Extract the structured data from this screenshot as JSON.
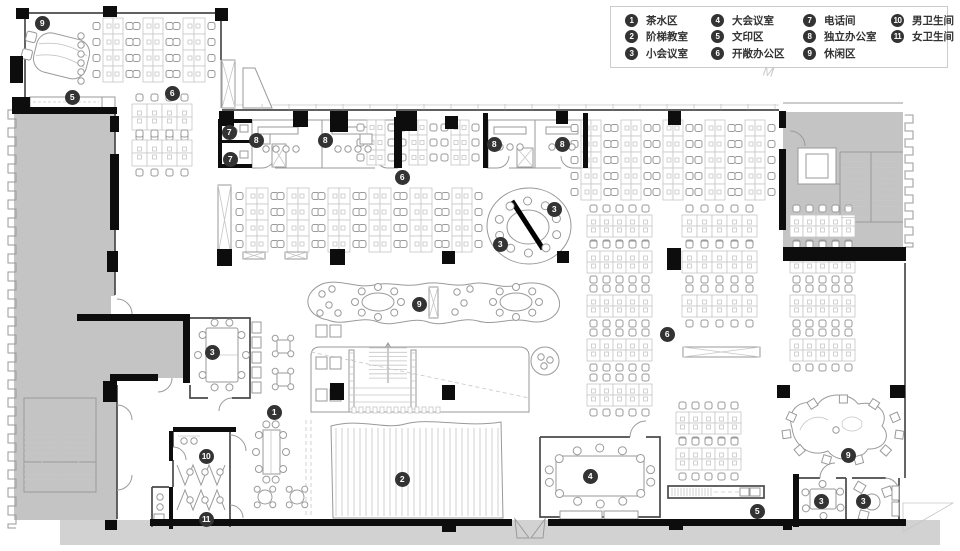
{
  "title": "办公楼层平面图",
  "watermark": "M",
  "colors": {
    "background": "#ffffff",
    "wall_black": "#0d0d0d",
    "wall_dark": "#4a4a4a",
    "line_light": "#c6c6c6",
    "line_mid": "#9a9a9a",
    "gray_zone": "#c4c4c4",
    "gray_walk": "#d2d2d2",
    "marker_bg": "#333333",
    "marker_text": "#ffffff",
    "legend_border": "#cccccc",
    "legend_text": "#333333"
  },
  "legend": {
    "items": [
      {
        "num": "1",
        "label": "茶水区"
      },
      {
        "num": "2",
        "label": "阶梯教室"
      },
      {
        "num": "3",
        "label": "小会议室"
      },
      {
        "num": "4",
        "label": "大会议室"
      },
      {
        "num": "5",
        "label": "文印区"
      },
      {
        "num": "6",
        "label": "开敞办公区"
      },
      {
        "num": "7",
        "label": "电话间"
      },
      {
        "num": "8",
        "label": "独立办公室"
      },
      {
        "num": "9",
        "label": "休闲区"
      },
      {
        "num": "10",
        "label": "男卫生间"
      },
      {
        "num": "11",
        "label": "女卫生间"
      }
    ]
  },
  "markers": [
    {
      "n": "9",
      "x": 42,
      "y": 23
    },
    {
      "n": "5",
      "x": 72,
      "y": 97
    },
    {
      "n": "6",
      "x": 172,
      "y": 93
    },
    {
      "n": "7",
      "x": 229,
      "y": 132
    },
    {
      "n": "8",
      "x": 256,
      "y": 140
    },
    {
      "n": "8",
      "x": 325,
      "y": 140
    },
    {
      "n": "7",
      "x": 230,
      "y": 159
    },
    {
      "n": "6",
      "x": 402,
      "y": 177
    },
    {
      "n": "8",
      "x": 494,
      "y": 144
    },
    {
      "n": "8",
      "x": 562,
      "y": 144
    },
    {
      "n": "3",
      "x": 554,
      "y": 209
    },
    {
      "n": "3",
      "x": 500,
      "y": 244
    },
    {
      "n": "9",
      "x": 419,
      "y": 304
    },
    {
      "n": "6",
      "x": 667,
      "y": 334
    },
    {
      "n": "3",
      "x": 212,
      "y": 352
    },
    {
      "n": "1",
      "x": 274,
      "y": 412
    },
    {
      "n": "10",
      "x": 206,
      "y": 456
    },
    {
      "n": "2",
      "x": 402,
      "y": 479
    },
    {
      "n": "4",
      "x": 590,
      "y": 476
    },
    {
      "n": "11",
      "x": 206,
      "y": 519
    },
    {
      "n": "5",
      "x": 757,
      "y": 511
    },
    {
      "n": "9",
      "x": 848,
      "y": 455
    },
    {
      "n": "3",
      "x": 821,
      "y": 501
    },
    {
      "n": "3",
      "x": 863,
      "y": 501
    }
  ],
  "floorplan": {
    "desk_clusters": [
      [
        103,
        18,
        2,
        4,
        10,
        16,
        "v"
      ],
      [
        143,
        18,
        2,
        4,
        10,
        16,
        "v"
      ],
      [
        183,
        18,
        2,
        4,
        11,
        16,
        "v"
      ],
      [
        132,
        104,
        4,
        2,
        15,
        13,
        "h"
      ],
      [
        132,
        140,
        4,
        2,
        15,
        13,
        "h"
      ],
      [
        367,
        120,
        2,
        3,
        9,
        15,
        "v"
      ],
      [
        409,
        120,
        2,
        3,
        9,
        15,
        "v"
      ],
      [
        451,
        120,
        2,
        3,
        9,
        15,
        "v"
      ],
      [
        246,
        188,
        2,
        4,
        11,
        16,
        "v"
      ],
      [
        287,
        188,
        2,
        4,
        11,
        16,
        "v"
      ],
      [
        328,
        188,
        2,
        4,
        11,
        16,
        "v"
      ],
      [
        369,
        188,
        2,
        4,
        11,
        16,
        "v"
      ],
      [
        410,
        188,
        2,
        4,
        11,
        16,
        "v"
      ],
      [
        452,
        188,
        2,
        4,
        10,
        16,
        "v"
      ],
      [
        581,
        120,
        2,
        5,
        10,
        16,
        "v"
      ],
      [
        621,
        120,
        2,
        5,
        10,
        16,
        "v"
      ],
      [
        663,
        120,
        2,
        5,
        10,
        16,
        "v"
      ],
      [
        705,
        120,
        2,
        5,
        10,
        16,
        "v"
      ],
      [
        745,
        120,
        2,
        5,
        10,
        16,
        "v"
      ],
      [
        587,
        215,
        5,
        2,
        13,
        11,
        "h"
      ],
      [
        587,
        251,
        5,
        2,
        13,
        11,
        "h"
      ],
      [
        587,
        295,
        5,
        2,
        13,
        11,
        "h"
      ],
      [
        587,
        339,
        5,
        2,
        13,
        11,
        "h"
      ],
      [
        587,
        384,
        5,
        2,
        13,
        11,
        "h"
      ],
      [
        682,
        215,
        5,
        2,
        15,
        11,
        "h"
      ],
      [
        682,
        251,
        5,
        2,
        15,
        11,
        "h"
      ],
      [
        682,
        295,
        5,
        2,
        15,
        11,
        "h"
      ],
      [
        790,
        215,
        5,
        2,
        13,
        11,
        "h"
      ],
      [
        790,
        251,
        5,
        2,
        13,
        11,
        "h"
      ],
      [
        790,
        295,
        5,
        2,
        13,
        11,
        "h"
      ],
      [
        790,
        339,
        5,
        2,
        13,
        11,
        "h"
      ],
      [
        676,
        412,
        5,
        2,
        13,
        11,
        "h"
      ],
      [
        676,
        448,
        5,
        2,
        13,
        11,
        "h"
      ]
    ],
    "black_rects": [
      [
        16,
        8,
        13,
        11
      ],
      [
        103,
        6,
        14,
        11
      ],
      [
        215,
        8,
        13,
        13
      ],
      [
        10,
        56,
        13,
        27
      ],
      [
        12,
        97,
        18,
        17
      ],
      [
        14,
        107,
        103,
        7
      ],
      [
        219,
        111,
        15,
        15
      ],
      [
        293,
        111,
        15,
        16
      ],
      [
        330,
        111,
        18,
        21
      ],
      [
        396,
        111,
        21,
        20
      ],
      [
        445,
        116,
        13,
        13
      ],
      [
        556,
        111,
        12,
        13
      ],
      [
        668,
        111,
        13,
        14
      ],
      [
        110,
        116,
        9,
        16
      ],
      [
        110,
        154,
        9,
        76
      ],
      [
        107,
        251,
        11,
        21
      ],
      [
        217,
        249,
        15,
        17
      ],
      [
        330,
        249,
        15,
        16
      ],
      [
        442,
        251,
        13,
        13
      ],
      [
        557,
        251,
        12,
        12
      ],
      [
        667,
        248,
        14,
        22
      ],
      [
        330,
        383,
        14,
        17
      ],
      [
        442,
        385,
        13,
        15
      ],
      [
        103,
        381,
        14,
        21
      ],
      [
        105,
        520,
        12,
        10
      ],
      [
        777,
        385,
        13,
        13
      ],
      [
        890,
        385,
        15,
        13
      ],
      [
        669,
        520,
        14,
        10
      ],
      [
        783,
        520,
        9,
        10
      ],
      [
        442,
        523,
        14,
        9
      ],
      [
        779,
        111,
        7,
        17
      ],
      [
        779,
        149,
        7,
        81
      ],
      [
        783,
        247,
        123,
        14
      ],
      [
        218,
        119,
        34,
        4
      ],
      [
        218,
        119,
        4,
        49
      ],
      [
        218,
        140,
        34,
        3
      ],
      [
        218,
        164,
        34,
        4
      ],
      [
        394,
        117,
        8,
        51
      ],
      [
        483,
        113,
        5,
        55
      ],
      [
        583,
        113,
        5,
        55
      ],
      [
        77,
        314,
        112,
        7
      ],
      [
        183,
        314,
        7,
        69
      ],
      [
        110,
        374,
        48,
        7
      ],
      [
        173,
        427,
        60,
        5
      ],
      [
        169,
        431,
        4,
        30
      ],
      [
        169,
        487,
        4,
        42
      ],
      [
        227,
        427,
        9,
        5
      ],
      [
        150,
        519,
        362,
        7
      ],
      [
        548,
        519,
        358,
        7
      ],
      [
        793,
        474,
        6,
        53
      ]
    ],
    "cabinets": [
      [
        222,
        60,
        13,
        48
      ],
      [
        218,
        185,
        13,
        70
      ],
      [
        243,
        252,
        22,
        7
      ],
      [
        285,
        252,
        22,
        7
      ],
      [
        683,
        347,
        77,
        10
      ],
      [
        429,
        287,
        9,
        31
      ],
      [
        517,
        148,
        16,
        19
      ],
      [
        272,
        144,
        14,
        23
      ]
    ],
    "benches": [
      [
        252,
        322,
        9,
        11
      ],
      [
        252,
        337,
        9,
        11
      ],
      [
        252,
        352,
        9,
        11
      ],
      [
        252,
        367,
        9,
        11
      ],
      [
        252,
        382,
        9,
        11
      ],
      [
        316,
        325,
        11,
        12
      ],
      [
        330,
        325,
        11,
        12
      ],
      [
        316,
        357,
        11,
        12
      ],
      [
        330,
        357,
        11,
        12
      ],
      [
        316,
        389,
        11,
        12
      ],
      [
        330,
        389,
        11,
        12
      ],
      [
        240,
        125,
        8,
        7
      ],
      [
        240,
        151,
        8,
        7
      ],
      [
        258,
        134,
        12,
        10
      ],
      [
        360,
        134,
        12,
        10
      ],
      [
        740,
        488,
        9,
        8
      ],
      [
        750,
        488,
        10,
        8
      ],
      [
        892,
        486,
        7,
        14
      ],
      [
        892,
        502,
        7,
        14
      ],
      [
        154,
        514,
        10,
        8
      ],
      [
        806,
        154,
        22,
        24
      ],
      [
        560,
        511,
        42,
        8
      ],
      [
        604,
        511,
        34,
        8
      ]
    ],
    "dots": [
      [
        234,
        131
      ],
      [
        234,
        158
      ],
      [
        266,
        149
      ],
      [
        276,
        149
      ],
      [
        286,
        149
      ],
      [
        296,
        149
      ],
      [
        338,
        149
      ],
      [
        348,
        149
      ],
      [
        358,
        149
      ],
      [
        368,
        149
      ],
      [
        500,
        147
      ],
      [
        510,
        147
      ],
      [
        520,
        147
      ],
      [
        552,
        147
      ],
      [
        562,
        147
      ],
      [
        572,
        147
      ],
      [
        184,
        441
      ],
      [
        194,
        441
      ],
      [
        160,
        497
      ],
      [
        160,
        507
      ],
      [
        190,
        472
      ],
      [
        205,
        472
      ],
      [
        220,
        472
      ],
      [
        190,
        500
      ],
      [
        205,
        500
      ],
      [
        220,
        500
      ],
      [
        81,
        36
      ],
      [
        81,
        45
      ],
      [
        81,
        54
      ],
      [
        81,
        63
      ],
      [
        81,
        72
      ],
      [
        81,
        81
      ],
      [
        541,
        357
      ],
      [
        550,
        360
      ],
      [
        544,
        366
      ],
      [
        836,
        430
      ],
      [
        322,
        294
      ],
      [
        332,
        289
      ],
      [
        329,
        305
      ],
      [
        320,
        313
      ],
      [
        338,
        313
      ],
      [
        457,
        292
      ],
      [
        470,
        289
      ],
      [
        464,
        303
      ],
      [
        455,
        312
      ]
    ],
    "chair_rings": [
      [
        528,
        227,
        30,
        26,
        10,
        4,
        0.3,
        "c"
      ],
      [
        378,
        302,
        23,
        15,
        8,
        3.5,
        0,
        "c"
      ],
      [
        516,
        302,
        23,
        15,
        8,
        3.5,
        0,
        "c"
      ],
      [
        222,
        355,
        24,
        34,
        10,
        3.5,
        0,
        "c"
      ],
      [
        283,
        346,
        11,
        11,
        4,
        3,
        0.78,
        "c"
      ],
      [
        283,
        379,
        11,
        11,
        4,
        3,
        0.78,
        "c"
      ],
      [
        265,
        497,
        11,
        11,
        4,
        3,
        0.78,
        "c"
      ],
      [
        297,
        497,
        11,
        11,
        4,
        3,
        0.78,
        "c"
      ],
      [
        271,
        452,
        15,
        29,
        10,
        3.5,
        0,
        "c"
      ],
      [
        600,
        476,
        52,
        28,
        14,
        4,
        0.22,
        "c"
      ],
      [
        823,
        500,
        20,
        16,
        6,
        3.5,
        0.5,
        "c"
      ],
      [
        843,
        430,
        57,
        31,
        11,
        4,
        0.15,
        "s"
      ]
    ],
    "vline_fields": [
      [
        336,
        500,
        6,
        428,
        516
      ],
      [
        672,
        712,
        3,
        488,
        496
      ],
      [
        36,
        94,
        5,
        505,
        520
      ],
      [
        235,
        779,
        27,
        104,
        109.5
      ]
    ],
    "hline_fields": [
      [
        24,
        56,
        5.3,
        432,
        490
      ],
      [
        60,
        92,
        5.3,
        432,
        490
      ],
      [
        841,
        869,
        5.6,
        156,
        218
      ],
      [
        873,
        901,
        5.6,
        156,
        218
      ],
      [
        369,
        407,
        4.3,
        348,
        382
      ],
      [
        349,
        354,
        7,
        353,
        409
      ],
      [
        411,
        416,
        7,
        353,
        409
      ]
    ],
    "tooth_rows": [
      [
        352,
        407,
        7,
        13,
        4,
        6
      ]
    ],
    "crenels": [
      [
        16,
        8,
        110,
        528,
        9
      ],
      [
        905,
        913,
        115,
        247,
        8
      ]
    ]
  }
}
